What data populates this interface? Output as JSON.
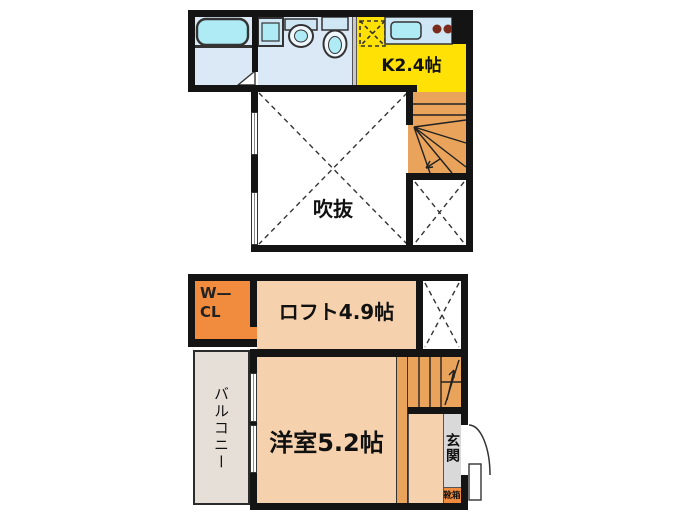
{
  "upper_floor": {
    "kitchen_label": "K2.4帖",
    "void_label": "吹抜"
  },
  "lower_floor": {
    "wcl_line1": "W—",
    "wcl_line2": "CL",
    "loft_label": "ロフト4.9帖",
    "room_label": "洋室5.2帖",
    "balcony_label": "バルコニー",
    "entrance_label": "玄関",
    "shoebox_label": "靴箱"
  },
  "colors": {
    "wall": "#141414",
    "wet_room_blue": "#dbe9f6",
    "fixture_blue": "#cfe6f4",
    "fixture_cyan": "#aeebf5",
    "kitchen_yellow": "#ffe105",
    "stair_orange": "#e9a35b",
    "closet_orange": "#f18c3e",
    "room_peach": "#f5d2ad",
    "balcony_gray": "#e6dfd7",
    "entrance_gray": "#d9d9d9",
    "line_dark": "#333333",
    "label_text": "#111111",
    "wcl_text": "#222222",
    "burner_brown": "#7b2b1b",
    "partition_gray": "#c8c8c8"
  }
}
